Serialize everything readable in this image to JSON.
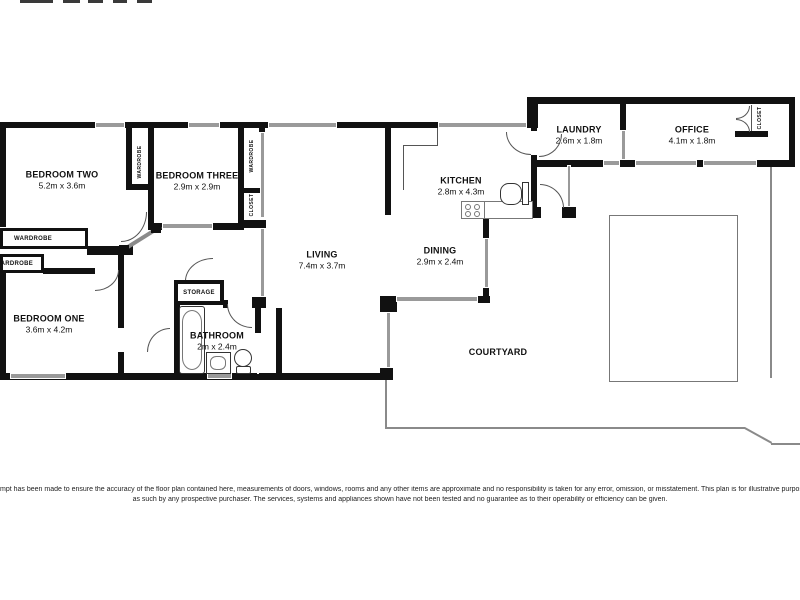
{
  "rooms": {
    "bedroom_two": {
      "name": "BEDROOM TWO",
      "dims": "5.2m x 3.6m"
    },
    "bedroom_three": {
      "name": "BEDROOM THREE",
      "dims": "2.9m x 2.9m"
    },
    "bedroom_one": {
      "name": "BEDROOM ONE",
      "dims": "3.6m x 4.2m"
    },
    "living": {
      "name": "LIVING",
      "dims": "7.4m x 3.7m"
    },
    "bathroom": {
      "name": "BATHROOM",
      "dims": "2m x 2.4m"
    },
    "kitchen": {
      "name": "KITCHEN",
      "dims": "2.8m x 4.3m"
    },
    "dining": {
      "name": "DINING",
      "dims": "2.9m x 2.4m"
    },
    "laundry": {
      "name": "LAUNDRY",
      "dims": "2.6m x 1.8m"
    },
    "office": {
      "name": "OFFICE",
      "dims": "4.1m x 1.8m"
    }
  },
  "areas": {
    "courtyard": "COURTYARD",
    "storage": "STORAGE"
  },
  "closets": {
    "wardrobe_box_main": "WARDROBE",
    "wardrobe_box_small": "WARDROBE",
    "wardrobe_bed2": "WARDROBE",
    "wardrobe_bed3": "WARDROBE",
    "closet_bed3": "CLOSET",
    "closet_office": "CLOSET"
  },
  "colors": {
    "wall": "#111111",
    "window": "#9a9a9a",
    "fence": "#8a8a8a",
    "door": "#555555",
    "background": "#ffffff"
  },
  "disclaimer": {
    "line1": "mpt has been made to ensure the accuracy of the floor plan contained here, measurements of doors, windows, rooms and any other items are approximate and no responsibility is taken for any error, omission, or misstatement. This plan is for illustrative purposes only and",
    "line2": "as such by any prospective purchaser. The services, systems and appliances shown have not been tested and no guarantee as to their operability or efficiency can be given."
  }
}
